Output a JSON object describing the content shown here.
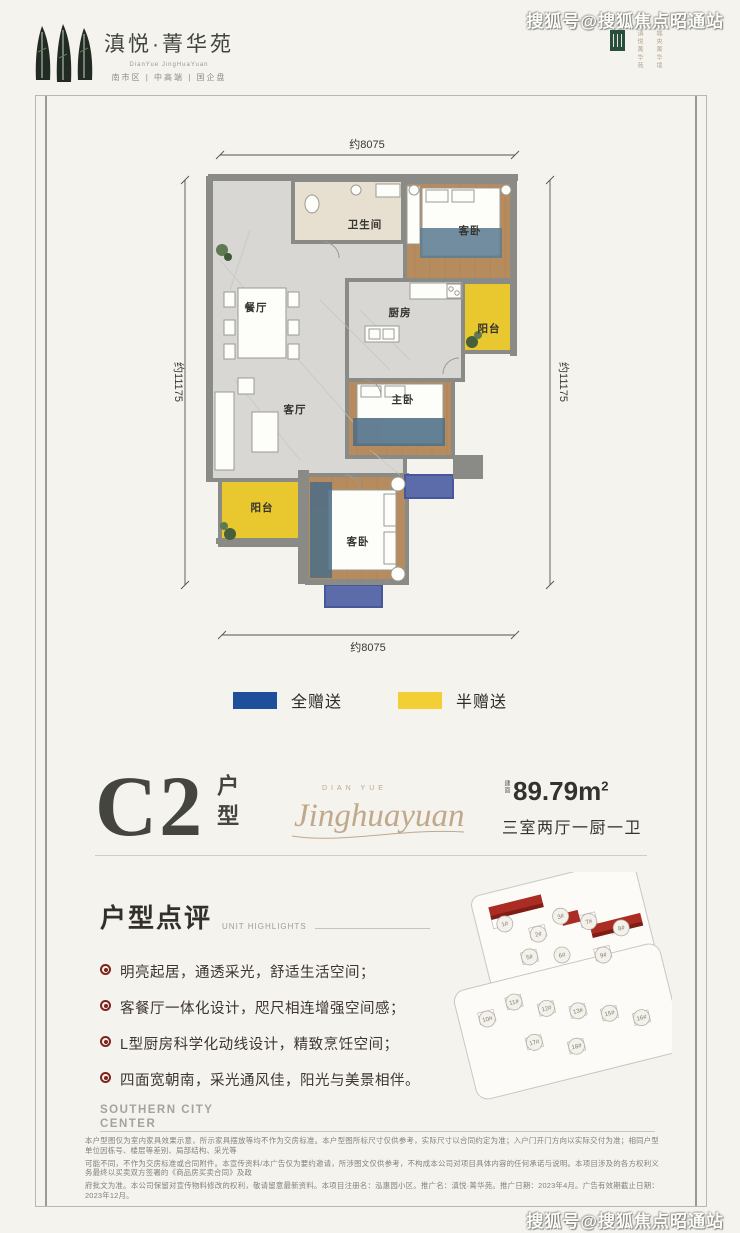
{
  "watermarks": {
    "top_right": "搜狐号@搜狐焦点昭通站",
    "bottom_right": "搜狐号@搜狐焦点昭通站"
  },
  "header": {
    "brand_name": "滇悦·菁华苑",
    "brand_name_en": "DianYue JingHuaYuan",
    "tagline": "南市区 | 中高端 | 国企盘",
    "emblem_text_1": "滇悦菁华苑",
    "emblem_text_2": "城央菁华境"
  },
  "floor_plan": {
    "dim_top": "约8075",
    "dim_bottom": "约8075",
    "dim_left": "约11175",
    "dim_right": "约11175",
    "rooms": {
      "bathroom": "卫生间",
      "bedroom_top": "客卧",
      "balcony_right": "阳台",
      "dining": "餐厅",
      "kitchen": "厨房",
      "living": "客厅",
      "master": "主卧",
      "balcony_left": "阳台",
      "bedroom_bottom": "客卧"
    },
    "colors": {
      "wall": "#8a8a86",
      "wood_floor": "#b68b5e",
      "marble_floor": "#d8d7d3",
      "bath_floor": "#e7dfd0",
      "balcony_half_gift": "#e9c72e",
      "full_gift_area": "#5c6cab"
    }
  },
  "legend": {
    "full_gift": {
      "label": "全赠送",
      "color": "#1d4f9a"
    },
    "half_gift": {
      "label": "半赠送",
      "color": "#f2cf35"
    }
  },
  "unit": {
    "code": "C2",
    "code_suffix": "户型",
    "signature_caps": "DIAN YUE",
    "signature_script": "Jinghuayuan",
    "area_label": "建面",
    "area_value": "89.79m",
    "area_sup": "2",
    "layout_desc": "三室两厅一厨一卫"
  },
  "highlights": {
    "title": "户型点评",
    "subtitle": "UNIT HIGHLIGHTS",
    "items": [
      "明亮起居，通透采光，舒适生活空间；",
      "客餐厅一体化设计，咫尺相连增强空间感；",
      "L型厨房科学化动线设计，精致烹饪空间；",
      "四面宽朝南，采光通风佳，阳光与美景相伴。"
    ]
  },
  "site_plan": {
    "highlight_color": "#ab2c22",
    "building_numbers": [
      "1#",
      "2#",
      "3#",
      "5#",
      "6#",
      "7#",
      "8#",
      "9#",
      "10#",
      "11#",
      "12#",
      "13#",
      "15#",
      "16#",
      "17#",
      "18#"
    ]
  },
  "footer": {
    "brand_line1": "SOUTHERN CITY",
    "brand_line2": "CENTER",
    "disclaimer_1": "本户型图仅为室内家具效果示意，所示家具摆放等均不作为交房标准。本户型图所标尺寸仅供参考，实际尺寸以合同约定为准；入户门开门方向以实际交付为准；相同户型单位因栋号、楼层等差别、局部结构、采光等",
    "disclaimer_2": "可能不同，不作为交房标准或合同附件。本宣传资料/本广告仅为要约邀请，所涉图文仅供参考，不构成本公司对项目具体内容的任何承诺与说明。本项目涉及的各方权利义务最终以买卖双方签署的《商品房买卖合同》及政",
    "disclaimer_3": "府批文为准。本公司保留对宣传物料修改的权利，敬请留意最新资料。本项目注册名：泓惠园小区。推广名：滇悦·菁华苑。推广日期：2023年4月。广告有效期截止日期：2023年12月。"
  }
}
